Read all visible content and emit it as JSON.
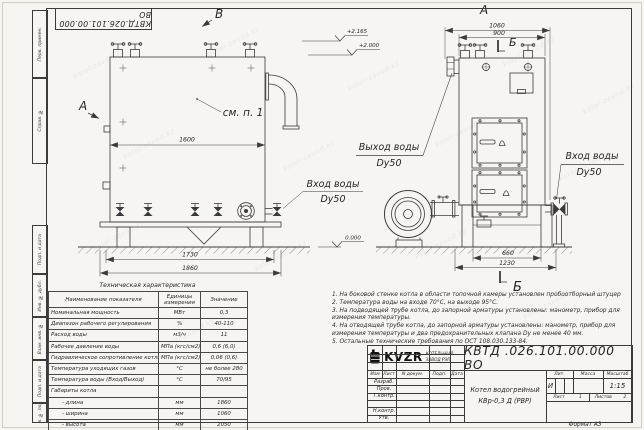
{
  "watermark": "kotel-zavod.kz",
  "stamp_top": "КВТД.026.101.00.000 ВО",
  "frame_stamps": {
    "top": [
      "Перв. примен.",
      "Справ. №"
    ],
    "bottom": [
      "Подп. и дата",
      "Инв. № дубл.",
      "Взам. инв. №",
      "Подп. и дата",
      "Инв. № подл."
    ]
  },
  "views": {
    "front": {
      "label_top": "В",
      "label_side": "А",
      "see_note": "см. п. 1",
      "dim_inner_width": "1600",
      "dim_legs": "1730",
      "dim_overall": "1860",
      "elev_zero": "0.000",
      "inlet_line1": "Вход воды",
      "inlet_line2": "Dy50"
    },
    "side": {
      "label": "А",
      "section_label_top": "Б",
      "section_label_bottom": "Б",
      "dim_overall": "1060",
      "dim_body": "900",
      "dim_legs": "660",
      "dim_base": "1230",
      "elev_top": "+2.165",
      "elev_mid": "+2.000",
      "outlet_line1": "Выход воды",
      "outlet_line2": "Dy50",
      "inlet_line1": "Вход воды",
      "inlet_line2": "Dy50"
    }
  },
  "spec_table": {
    "title": "Техническая характеристика",
    "col_name": "Наименование показателя",
    "col_units_line1": "Единицы",
    "col_units_line2": "измерения",
    "col_value": "Значение",
    "rows": [
      {
        "name": "Номинальная мощность",
        "units": "МВт",
        "value": "0,3"
      },
      {
        "name": "Диапазон рабочего регулирования",
        "units": "%",
        "value": "40-110"
      },
      {
        "name": "Расход воды",
        "units": "м3/ч",
        "value": "11"
      },
      {
        "name": "Рабочее давление воды",
        "units": "МПа (кгс/см2)",
        "value": "0,6 (6,0)"
      },
      {
        "name": "Гидравлическое сопротивление котла",
        "units": "МПа (кгс/см2)",
        "value": "0,06 (0,6)"
      },
      {
        "name": "Температура уходящих газов",
        "units": "°С",
        "value": "не более 280"
      },
      {
        "name": "Температура воды (Вход/Выход)",
        "units": "°С",
        "value": "70/95"
      },
      {
        "name": "Габариты котла",
        "units": "",
        "value": ""
      },
      {
        "name": "- длина",
        "units": "мм",
        "value": "1860"
      },
      {
        "name": "- ширина",
        "units": "мм",
        "value": "1060"
      },
      {
        "name": "- высота",
        "units": "мм",
        "value": "2050"
      }
    ]
  },
  "notes": [
    "1. На боковой стенке котла в области топочной камеры установлен пробоотборный штуцер",
    "2. Температура воды на входе 70°С, на выходе 95°С.",
    "3. На подводящей трубе котла, до запорной арматуры установлены: манометр, прибор для измерения температуры.",
    "4. На отводящей трубе котла, до запорной арматуры установлены: манометр, прибор для измерения температуры и два предохранительных клапана Dу не менее 40 мм.",
    "5. Остальные технические требования по ОСТ 108.030.133-84."
  ],
  "title_block": {
    "doc_number": "КВТД .026.101.00.000  ВО",
    "product_name_line1": "Котел водогрейный",
    "product_name_line2": "КВр-0,3 Д (РВР)",
    "header_cols": [
      "Изм",
      "Лист",
      "N докум.",
      "Подп.",
      "Дата"
    ],
    "roles": [
      "Разраб.",
      "Пров.",
      "Т.контр.",
      "",
      "Н.контр.",
      "Утв."
    ],
    "lit_label": "Лит.",
    "lit_value": "И",
    "mass_label": "Масса",
    "scale_label": "Масштаб",
    "scale_value": "1:15",
    "sheet_label": "Лист",
    "sheet_value": "1",
    "sheets_label": "Листов",
    "sheets_value": "2",
    "logo_text": "KVZR",
    "company_line1": "КОТЕЛЬНЫЙ",
    "company_line2": "ЗАВОД РЭП",
    "format_label": "Формат  А3"
  }
}
